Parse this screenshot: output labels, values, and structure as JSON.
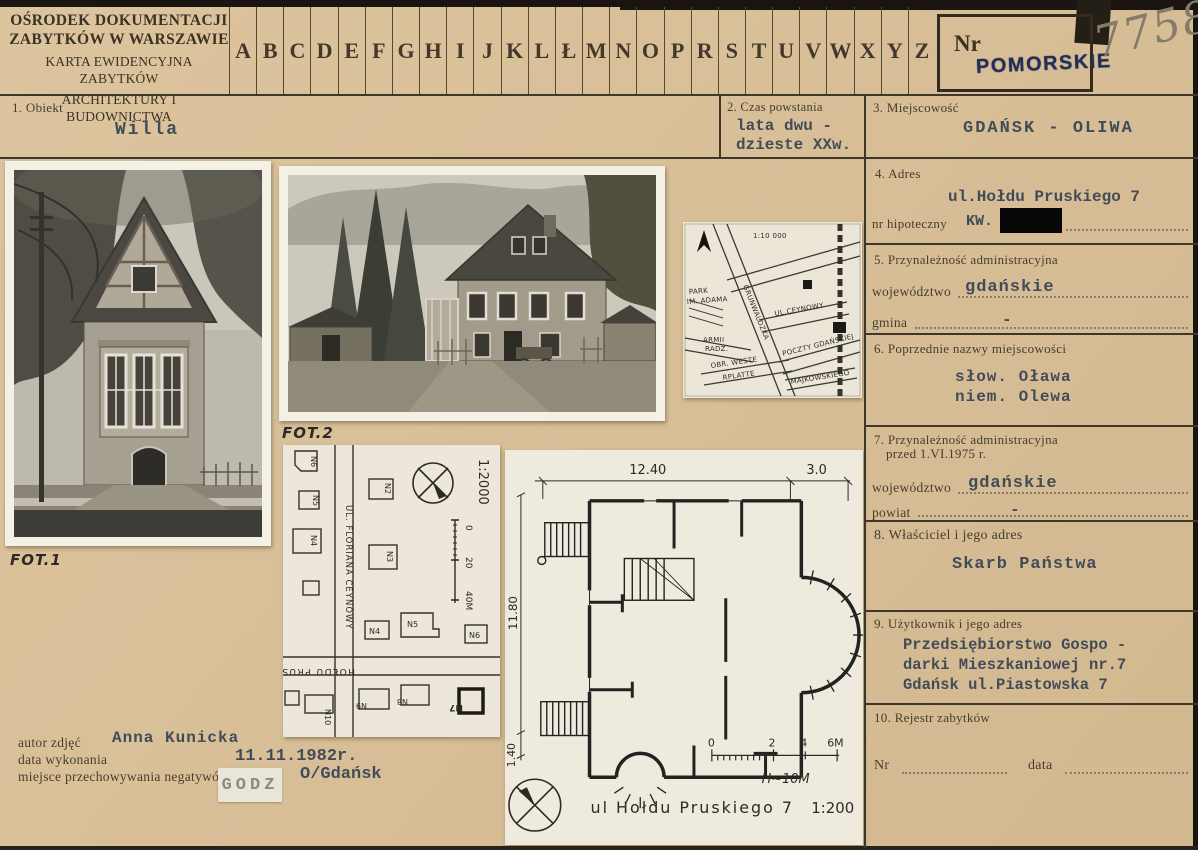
{
  "header": {
    "org_line1": "OŚRODEK DOKUMENTACJI",
    "org_line2": "ZABYTKÓW W WARSZAWIE",
    "card_line1": "KARTA EWIDENCYJNA ZABYTKÓW",
    "card_line2": "ARCHITEKTURY I BUDOWNICTWA",
    "alphabet": [
      "A",
      "B",
      "C",
      "D",
      "E",
      "F",
      "G",
      "H",
      "I",
      "J",
      "K",
      "L",
      "Ł",
      "M",
      "N",
      "O",
      "P",
      "R",
      "S",
      "T",
      "U",
      "V",
      "W",
      "X",
      "Y",
      "Z"
    ],
    "nr_label": "Nr",
    "region_stamp": "POMORSKIE",
    "card_number": "7758"
  },
  "fields": {
    "f1": {
      "label": "1. Obiekt",
      "value": "Willa"
    },
    "f2": {
      "label": "2. Czas powstania",
      "value_line1": "lata dwu -",
      "value_line2": "dzieste XXw."
    },
    "f3": {
      "label": "3. Miejscowość",
      "value": "GDAŃSK - OLIWA"
    },
    "f4": {
      "label": "4. Adres",
      "value": "ul.Hołdu Pruskiego 7",
      "sub_label": "nr hipoteczny",
      "sub_value": "KW."
    },
    "f5": {
      "label": "5. Przynależność administracyjna",
      "row1_label": "województwo",
      "row1_value": "gdańskie",
      "row2_label": "gmina",
      "row2_value": "-"
    },
    "f6": {
      "label": "6. Poprzednie nazwy miejscowości",
      "value_line1": "słow. Oława",
      "value_line2": "niem. Olewa"
    },
    "f7": {
      "label_line1": "7. Przynależność administracyjna",
      "label_line2": "przed 1.VI.1975 r.",
      "row1_label": "województwo",
      "row1_value": "gdańskie",
      "row2_label": "powiat",
      "row2_value": "-"
    },
    "f8": {
      "label": "8. Właściciel i jego adres",
      "value": "Skarb Państwa"
    },
    "f9": {
      "label": "9. Użytkownik i jego adres",
      "value_line1": "Przedsiębiorstwo Gospo -",
      "value_line2": "darki Mieszkaniowej nr.7",
      "value_line3": "Gdańsk ul.Piastowska 7"
    },
    "f10": {
      "label": "10. Rejestr zabytków",
      "nr_label": "Nr",
      "data_label": "data"
    }
  },
  "photos": {
    "fot1_label": "FOT.1",
    "fot2_label": "FOT.2"
  },
  "credits": {
    "author_label": "autor zdjęć",
    "author_value": "Anna Kunicka",
    "date_label": "data wykonania",
    "date_value": "11.11.1982r.",
    "negatives_label": "miejsce przechowywania negatywów",
    "negatives_stamp": "GODZ",
    "negatives_value": "O/Gdańsk"
  },
  "location_map": {
    "scale_label": "1:10 000",
    "park_line1": "PARK",
    "park_line2": "IM. ADAMA",
    "street_grunwaldzka": "GRUNWALDZKA",
    "street_ceynowy": "UL.CEYNOWY",
    "armii_line1": "ARMII",
    "armii_line2": "RADZ.",
    "westerplatte_line1": "OBR. WESTE",
    "westerplatte_line2": "RPLATTE",
    "street_pocztowa": "POCZTY GDAŃSKIEJ",
    "street_majkowskiego": "MAJKOWSKIEGO"
  },
  "site_map": {
    "scale_label": "1:2000",
    "street_vertical": "UL. FLORIANA CEYNOWY",
    "street_horizontal": "HOŁDU PRUSKIEGO",
    "tick0": "0",
    "tick20": "20",
    "tick40": "40M",
    "houses": {
      "n6": "N6",
      "n5": "N5",
      "n4": "N4",
      "n2": "N2",
      "n3": "N3",
      "r4": "N4",
      "r5": "N5",
      "r6": "N6",
      "b10": "N10",
      "b9": "N9",
      "b8": "N8",
      "b7": "N7"
    }
  },
  "floor_plan": {
    "dim_width": "12.40",
    "dim_right": "3.0",
    "dim_height": "11.80",
    "dim_small": "1.40",
    "tick0": "0",
    "tick2": "2",
    "tick4": "4",
    "tick6": "6M",
    "height_note": "H~10M",
    "caption": "ul Hołdu Pruskiego 7",
    "scale_label": "1:200"
  },
  "colors": {
    "card_background": "#d8bf98",
    "stamp_blue": "#242f55",
    "typed_ink": "#424c58",
    "pencil_gray": "#847b6a",
    "rule_ink": "#3f382a"
  }
}
